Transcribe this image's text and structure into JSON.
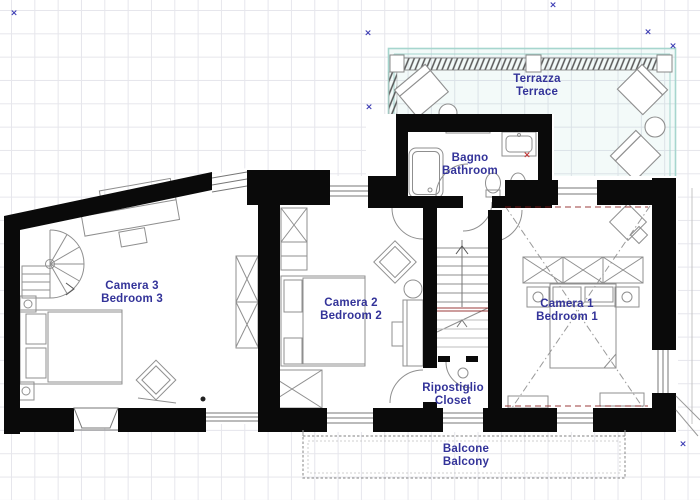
{
  "plan": {
    "type": "floor-plan",
    "floor": "upper floor with terrace and balcony"
  },
  "labels": {
    "terrace": {
      "it": "Terrazza",
      "en": "Terrace"
    },
    "bathroom": {
      "it": "Bagno",
      "en": "Bathroom"
    },
    "bedroom3": {
      "it": "Camera 3",
      "en": "Bedroom 3"
    },
    "bedroom2": {
      "it": "Camera 2",
      "en": "Bedroom 2"
    },
    "bedroom1": {
      "it": "Camera 1",
      "en": "Bedroom 1"
    },
    "closet": {
      "it": "Ripostiglio",
      "en": "Closet"
    },
    "balcony": {
      "it": "Balcone",
      "en": "Balcony"
    }
  },
  "colors": {
    "label_text": "#333399",
    "wall": "#0a0a0a",
    "terrace_border": "#a6d6ce",
    "furniture_line": "#8f8f8f",
    "grid_line": "#e6e6ec",
    "marker_blue": "#3b3bb3",
    "marker_red": "#c23434",
    "accent_dark_red": "#8a1a1a"
  },
  "markers": {
    "blue": [
      {
        "x": 14,
        "y": 14
      },
      {
        "x": 368,
        "y": 34
      },
      {
        "x": 553,
        "y": 6
      },
      {
        "x": 648,
        "y": 33
      },
      {
        "x": 673,
        "y": 47
      },
      {
        "x": 369,
        "y": 108
      },
      {
        "x": 683,
        "y": 445
      }
    ],
    "red": [
      {
        "x": 527,
        "y": 156
      }
    ]
  }
}
